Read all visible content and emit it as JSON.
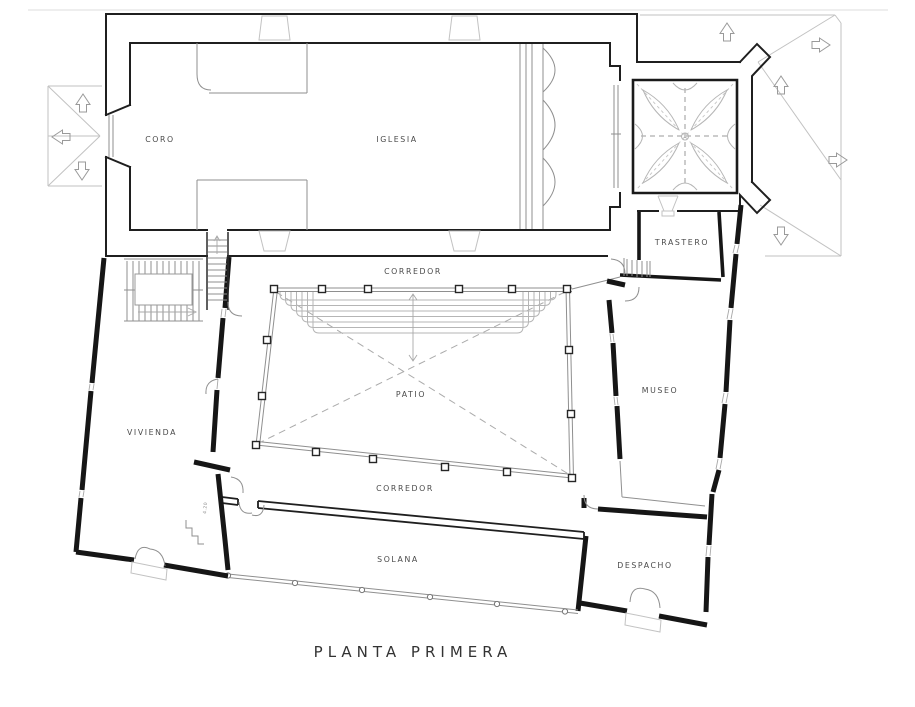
{
  "document": {
    "title": "PLANTA PRIMERA"
  },
  "rooms": {
    "coro": {
      "label": "CORO"
    },
    "iglesia": {
      "label": "IGLESIA"
    },
    "trastero": {
      "label": "TRASTERO"
    },
    "corredor_norte": {
      "label": "CORREDOR"
    },
    "patio": {
      "label": "PATIO"
    },
    "museo": {
      "label": "MUSEO"
    },
    "vivienda": {
      "label": "VIVIENDA"
    },
    "corredor_sur": {
      "label": "CORREDOR"
    },
    "solana": {
      "label": "SOLANA"
    },
    "despacho": {
      "label": "DESPACHO"
    }
  },
  "annotations": {
    "stair_dimension": "4.20"
  },
  "symbols": {
    "slope_arrow": "roof-slope-direction-arrow",
    "column": "patio-colonnade-column",
    "post": "solana-timber-post",
    "vault": "ribbed-cross-vault",
    "stairs": "staircase"
  },
  "colors": {
    "wall": "#1c1c1c",
    "detail_gray": "#8f8f8f",
    "light_gray": "#c2c2c2",
    "background": "#ffffff",
    "text": "#4a4a4a"
  }
}
